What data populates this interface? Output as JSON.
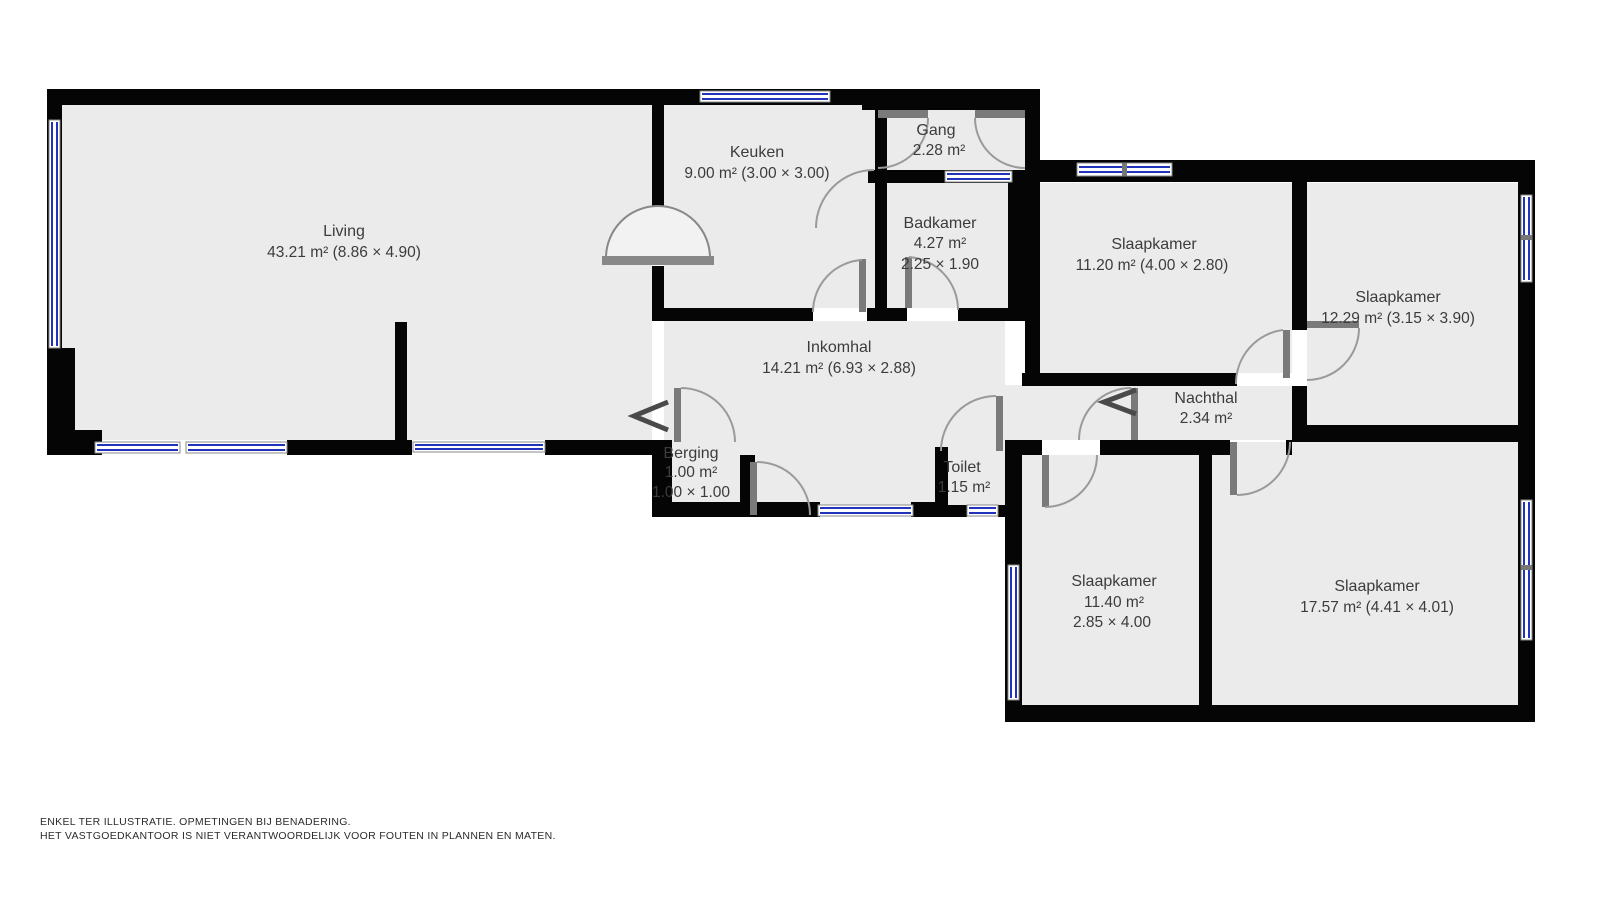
{
  "title": "floor-plan",
  "rooms": {
    "living": {
      "name": "Living",
      "size": "43.21 m² (8.86 × 4.90)"
    },
    "keuken": {
      "name": "Keuken",
      "size": "9.00 m² (3.00 × 3.00)"
    },
    "gang": {
      "name": "Gang",
      "size": "2.28 m²"
    },
    "badkamer": {
      "name": "Badkamer",
      "size": "4.27 m²",
      "dims": "2.25 × 1.90"
    },
    "slaapkamer_nw": {
      "name": "Slaapkamer",
      "size": "11.20 m² (4.00 × 2.80)"
    },
    "slaapkamer_ne": {
      "name": "Slaapkamer",
      "size": "12.29 m² (3.15 × 3.90)"
    },
    "inkomhal": {
      "name": "Inkomhal",
      "size": "14.21 m² (6.93 × 2.88)"
    },
    "nachthal": {
      "name": "Nachthal",
      "size": "2.34 m²"
    },
    "berging": {
      "name": "Berging",
      "size": "1.00 m²",
      "dims": "1.00 × 1.00"
    },
    "toilet": {
      "name": "Toilet",
      "size": "1.15 m²"
    },
    "slaapkamer_sw": {
      "name": "Slaapkamer",
      "size": "11.40 m²",
      "dims": "2.85 × 4.00"
    },
    "slaapkamer_se": {
      "name": "Slaapkamer",
      "size": "17.57 m² (4.41 × 4.01)"
    }
  },
  "disclaimer": {
    "line1": "ENKEL TER ILLUSTRATIE. OPMETINGEN BIJ BENADERING.",
    "line2": "HET VASTGOEDKANTOOR IS NIET VERANTWOORDELIJK VOOR FOUTEN IN PLANNEN EN MATEN."
  },
  "colors": {
    "wall": "#050505",
    "floor": "#ebebeb",
    "window_glass": "#2233bb",
    "door_arc": "#9a9a9a",
    "label_text": "#3c3c3c"
  }
}
